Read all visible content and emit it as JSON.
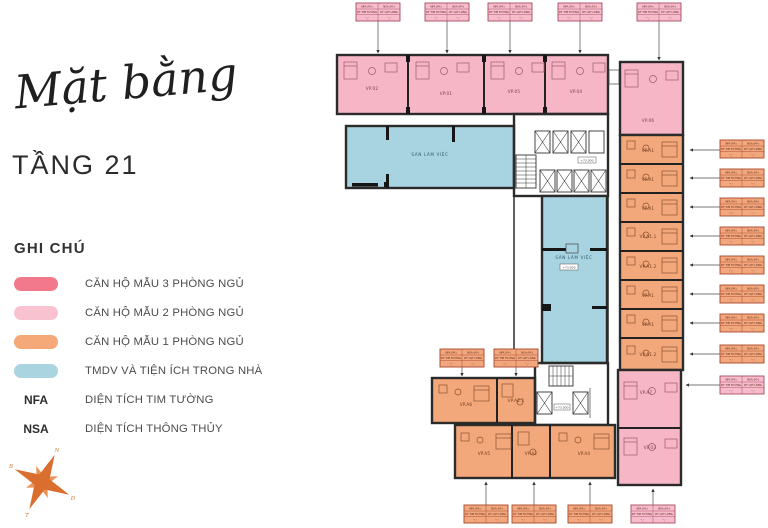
{
  "header": {
    "script_title": "Mặt bằng",
    "floor_title": "TẦNG 21"
  },
  "legend": {
    "title": "GHI CHÚ",
    "items": [
      {
        "label": "CĂN HỘ MẪU 3 PHÒNG NGỦ",
        "color": "#F2798C"
      },
      {
        "label": "CĂN HỘ MẪU 2 PHÒNG NGỦ",
        "color": "#F9C2D0"
      },
      {
        "label": "CĂN HỘ MẪU 1 PHÒNG NGỦ",
        "color": "#F5A978"
      },
      {
        "label": "TMDV VÀ TIỆN ÍCH TRONG NHÀ",
        "color": "#A9D4E0"
      }
    ],
    "abbrevs": [
      {
        "key": "NFA",
        "label": "DIỆN TÍCH TIM TƯỜNG"
      },
      {
        "key": "NSA",
        "label": "DIỆN TÍCH THÔNG THỦY"
      }
    ]
  },
  "compass": {
    "tr": "N",
    "br": "Đ",
    "bl": "T",
    "tl": "B"
  },
  "plan": {
    "colors": {
      "bed2": "#F6B6C6",
      "bed1": "#F3A87B",
      "amenity": "#A8D3E0",
      "wall": "#2B2B2B"
    },
    "amenity_label": "SÀN LÀM VIỆC",
    "elevation_label": "+73.000",
    "units": {
      "top": [
        "VP.02",
        "VP.01",
        "VP.05",
        "VP.04"
      ],
      "top_right": "VP.06",
      "right": [
        "VP.A1",
        "VP.A1",
        "VP.A1",
        "VP.A1.1",
        "VP.A1.2",
        "VP.A1",
        "VP.A1",
        "VP.A1.2"
      ],
      "bottom_upper": [
        "VP.A6",
        "VP.A2.1"
      ],
      "bottom_lower": [
        "VP.A5",
        "VP.A2",
        "VP.A4"
      ],
      "bottom_right": [
        "VP.A7",
        "VP.03"
      ]
    },
    "callout": {
      "nfa_header": "NFA (M²)",
      "nsa_header": "NSA (M²)",
      "nfa_sub": "DT TIM TƯỜNG",
      "nsa_sub": "DT LỌT LÒNG",
      "nfa_value": "··,·",
      "nsa_value": "··,·"
    }
  }
}
